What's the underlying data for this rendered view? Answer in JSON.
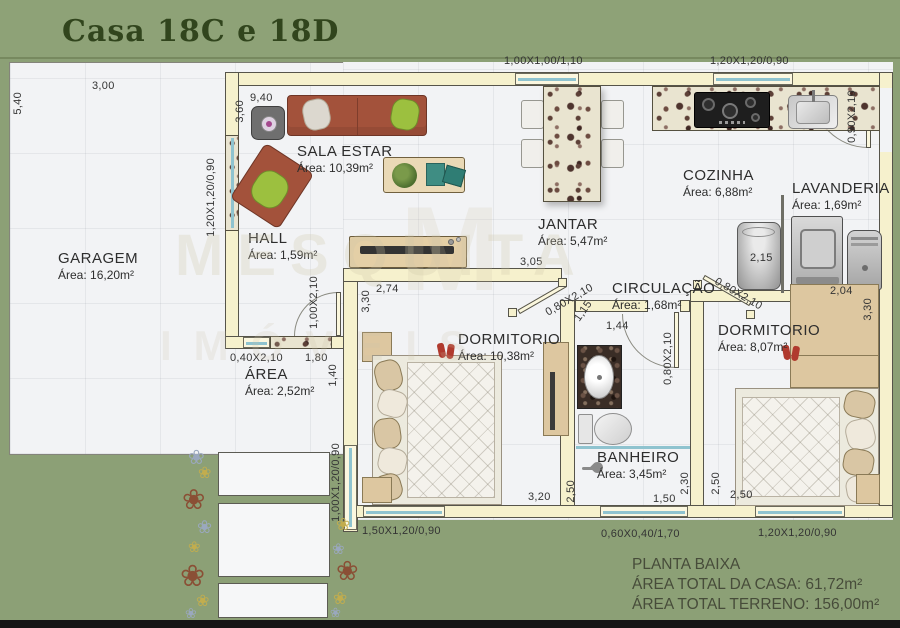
{
  "title": "Casa 18C e 18D",
  "watermark": {
    "logo": "M",
    "line1": "MESQUITA",
    "line2": "IMÓVEIS"
  },
  "icons": {
    "flower": "❀"
  },
  "rooms": {
    "garagem": {
      "name": "GARAGEM",
      "area": "Área: 16,20m²"
    },
    "sala": {
      "name": "SALA ESTAR",
      "area": "Área: 10,39m²"
    },
    "hall": {
      "name": "HALL",
      "area": "Área: 1,59m²"
    },
    "jantar": {
      "name": "JANTAR",
      "area": "Área: 5,47m²"
    },
    "cozinha": {
      "name": "COZINHA",
      "area": "Área: 6,88m²"
    },
    "lavanderia": {
      "name": "LAVANDERIA",
      "area": "Área: 1,69m²"
    },
    "circulacao": {
      "name": "CIRCULAÇÃO",
      "area": "Área: 1,68m²"
    },
    "dormitorio1": {
      "name": "DORMITORIO",
      "area": "Área: 10,38m²"
    },
    "dormitorio2": {
      "name": "DORMITORIO",
      "area": "Área: 8,07m²"
    },
    "banheiro": {
      "name": "BANHEIRO",
      "area": "Área: 3,45m²"
    },
    "area_servico": {
      "name": "ÁREA",
      "area": "Área: 2,52m²"
    }
  },
  "dims": {
    "lot_w": "3,00",
    "lot_h": "5,40",
    "sala_w": "9,40",
    "sala_h": "3,60",
    "win_sala_left": "1,20X1,20/0,90",
    "win_jantar_top": "1,00X1,00/1,10",
    "win_cozinha_top": "1,20X1,20/0,90",
    "door_lavanderia": "0,90X2,10",
    "lavanderia_w": "2,15",
    "jantar_w": "3,05",
    "door_dorm1": "0,80X2,10",
    "circ_d1": "1,15",
    "circ_d2": "1,44",
    "door_banheiro": "0,80X2,10",
    "door_dorm2": "0,80X2,10",
    "dorm2_w": "2,04",
    "dorm2_h": "3,30",
    "dorm1_w": "2,74",
    "dorm1_h": "3,30",
    "door_hall": "1,00X2,10",
    "door_area": "0,40X2,10",
    "area_w": "1,80",
    "area_h": "1,40",
    "win_dorm1_left": "1,00X1,20/0,90",
    "dorm1_bw": "3,20",
    "dorm1_bh": "2,50",
    "win_dorm1_bottom": "1,50X1,20/0,90",
    "win_banheiro_bottom": "0,60X0,40/1,70",
    "banheiro_w": "1,50",
    "banheiro_h": "2,30",
    "dorm2_lh": "2,50",
    "dorm2_bw": "2,50",
    "win_dorm2_bottom": "1,20X1,20/0,90"
  },
  "footer": {
    "line1": "PLANTA BAIXA",
    "line2": "ÁREA TOTAL DA CASA: 61,72m²",
    "line3": "ÁREA TOTAL TERRENO: 156,00m²"
  },
  "colors": {
    "background_green": "#8ca076",
    "wall_cream": "#f6f1cd",
    "title_green": "#31451d",
    "glass_blue": "#8fc3cf",
    "sofa_terracotta": "#a3523b"
  }
}
